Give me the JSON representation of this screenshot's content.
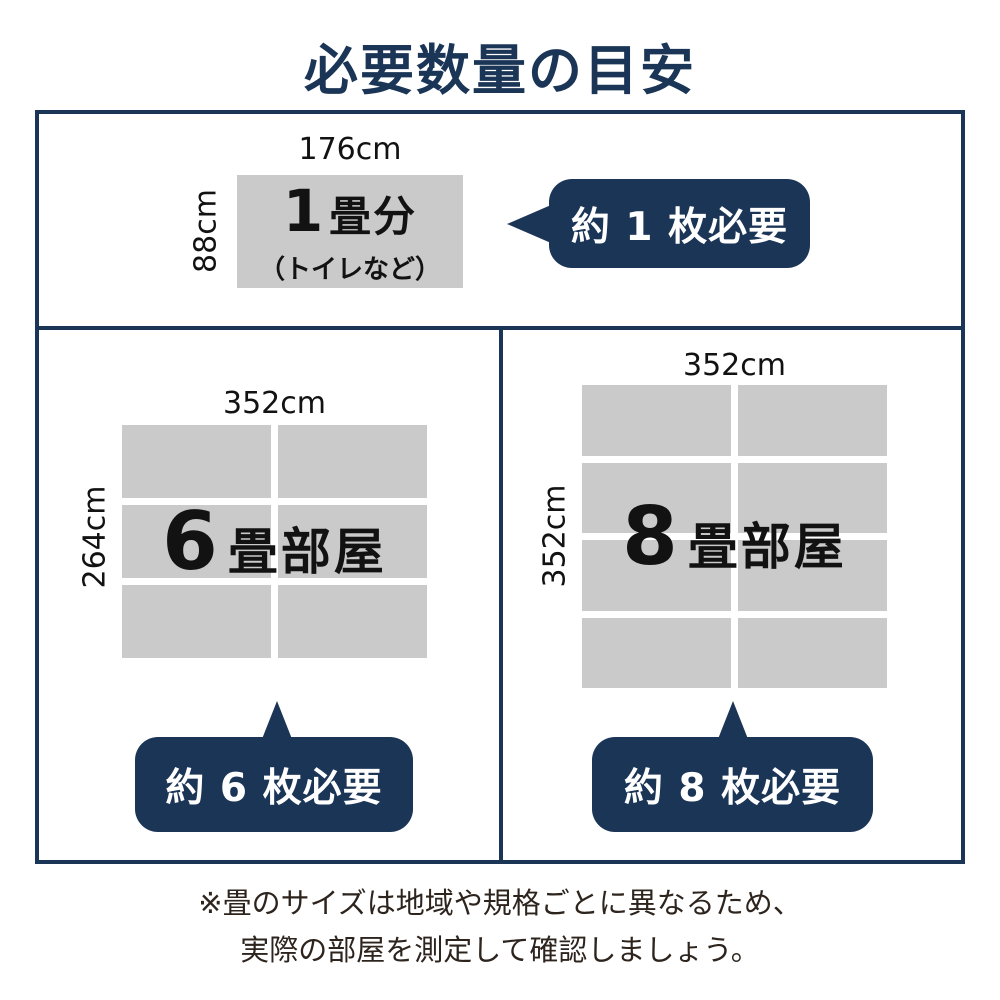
{
  "title": "必要数量の目安",
  "colors": {
    "navy": "#1b3557",
    "mat_gray": "#cacaca",
    "text": "#121212",
    "footer_text": "#2e241e"
  },
  "sections": {
    "one_mat": {
      "width_label": "176cm",
      "height_label": "88cm",
      "room_num": "1",
      "room_rest": "畳分",
      "room_sub": "（トイレなど）",
      "badge_label": "約 1 枚必要"
    },
    "six_mat": {
      "width_label": "352cm",
      "height_label": "264cm",
      "room_num": "6",
      "room_rest": "畳部屋",
      "badge_label": "約 6 枚必要",
      "grid": {
        "rows": 3,
        "cols": 2
      }
    },
    "eight_mat": {
      "width_label": "352cm",
      "height_label": "352cm",
      "room_num": "8",
      "room_rest": "畳部屋",
      "badge_label": "約 8 枚必要",
      "grid": {
        "rows": 4,
        "cols": 2
      }
    }
  },
  "footer": {
    "line1": "※畳のサイズは地域や規格ごとに異なるため、",
    "line2": "実際の部屋を測定して確認しましょう。"
  }
}
